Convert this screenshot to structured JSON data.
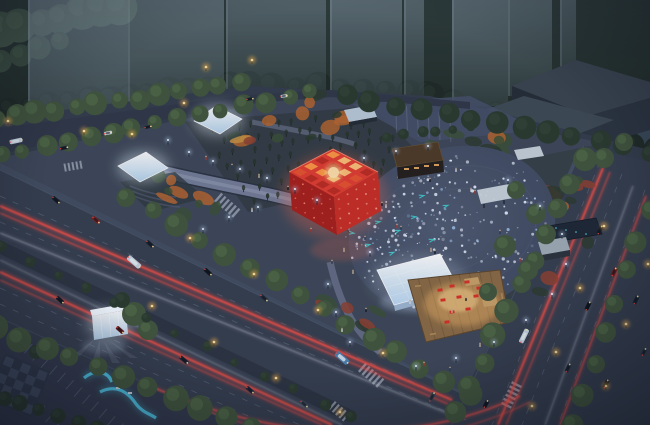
{
  "scene": {
    "type": "architectural-night-rendering",
    "view": "aerial",
    "subject": "urban-park-plaza-with-red-cube-pavilion"
  },
  "seed": 11,
  "counts": {
    "plaza_dots": 240,
    "plaza_dots_west": 55,
    "grove_rows": 7,
    "grove_cols": 14
  },
  "colors": {
    "sky_top": "#4e5f6d",
    "sky_mid": "#31404f",
    "ground_base": "#333c4b",
    "far_trees": "#1f2a25",
    "hill_green": "#45584a",
    "tower_glass": "#8ba0b4",
    "slab_top": "#3a4450",
    "slab_side": "#242c37",
    "slab_front": "#2c3540",
    "park_ground": "#3d4758",
    "park_dark": "#333b44",
    "road": "#363e4f",
    "road_dark": "#2c3442",
    "sidewalk": "#454f63",
    "lane_line": "#9aa4b8",
    "trail_red": "#ff5044",
    "trail_white": "#dde4f0",
    "tree_street": "#42553c",
    "tree_light": "#5d7b51",
    "tree_dark": "#2b3a2e",
    "grove_tree": "#26332b",
    "garden_green": "#3b5037",
    "autumn_orange": "#b5652f",
    "autumn_red": "#8e4030",
    "autumn_yellow": "#c8913f",
    "path_gray": "#7b84a0",
    "plaza_fill": "#47526a",
    "plaza_dot": "#eaf1ff",
    "teal_mark": "#3fd8d8",
    "cube_red": "#e03c30",
    "cube_red_dark": "#a81f1b",
    "cube_red_mid": "#c92d24",
    "cube_glow": "#ff6a4e",
    "panel_warm": "#ffc66a",
    "canopy_white": "#e9f3fc",
    "deck_wood": "#8a6a44",
    "deck_glow": "#ffbe6e",
    "furniture_red": "#d92f27",
    "ribbon_blue": "#4fc6e6",
    "glass_glow": "#eaf6ff",
    "lamp_warm": "#ffc966",
    "lamp_cool": "#eef4ff",
    "bus_blue": "#4a7fae",
    "vehicle_light": "#c9d4e2",
    "vehicle_dark": "#1d2430",
    "water_dark": "#1d2735"
  }
}
